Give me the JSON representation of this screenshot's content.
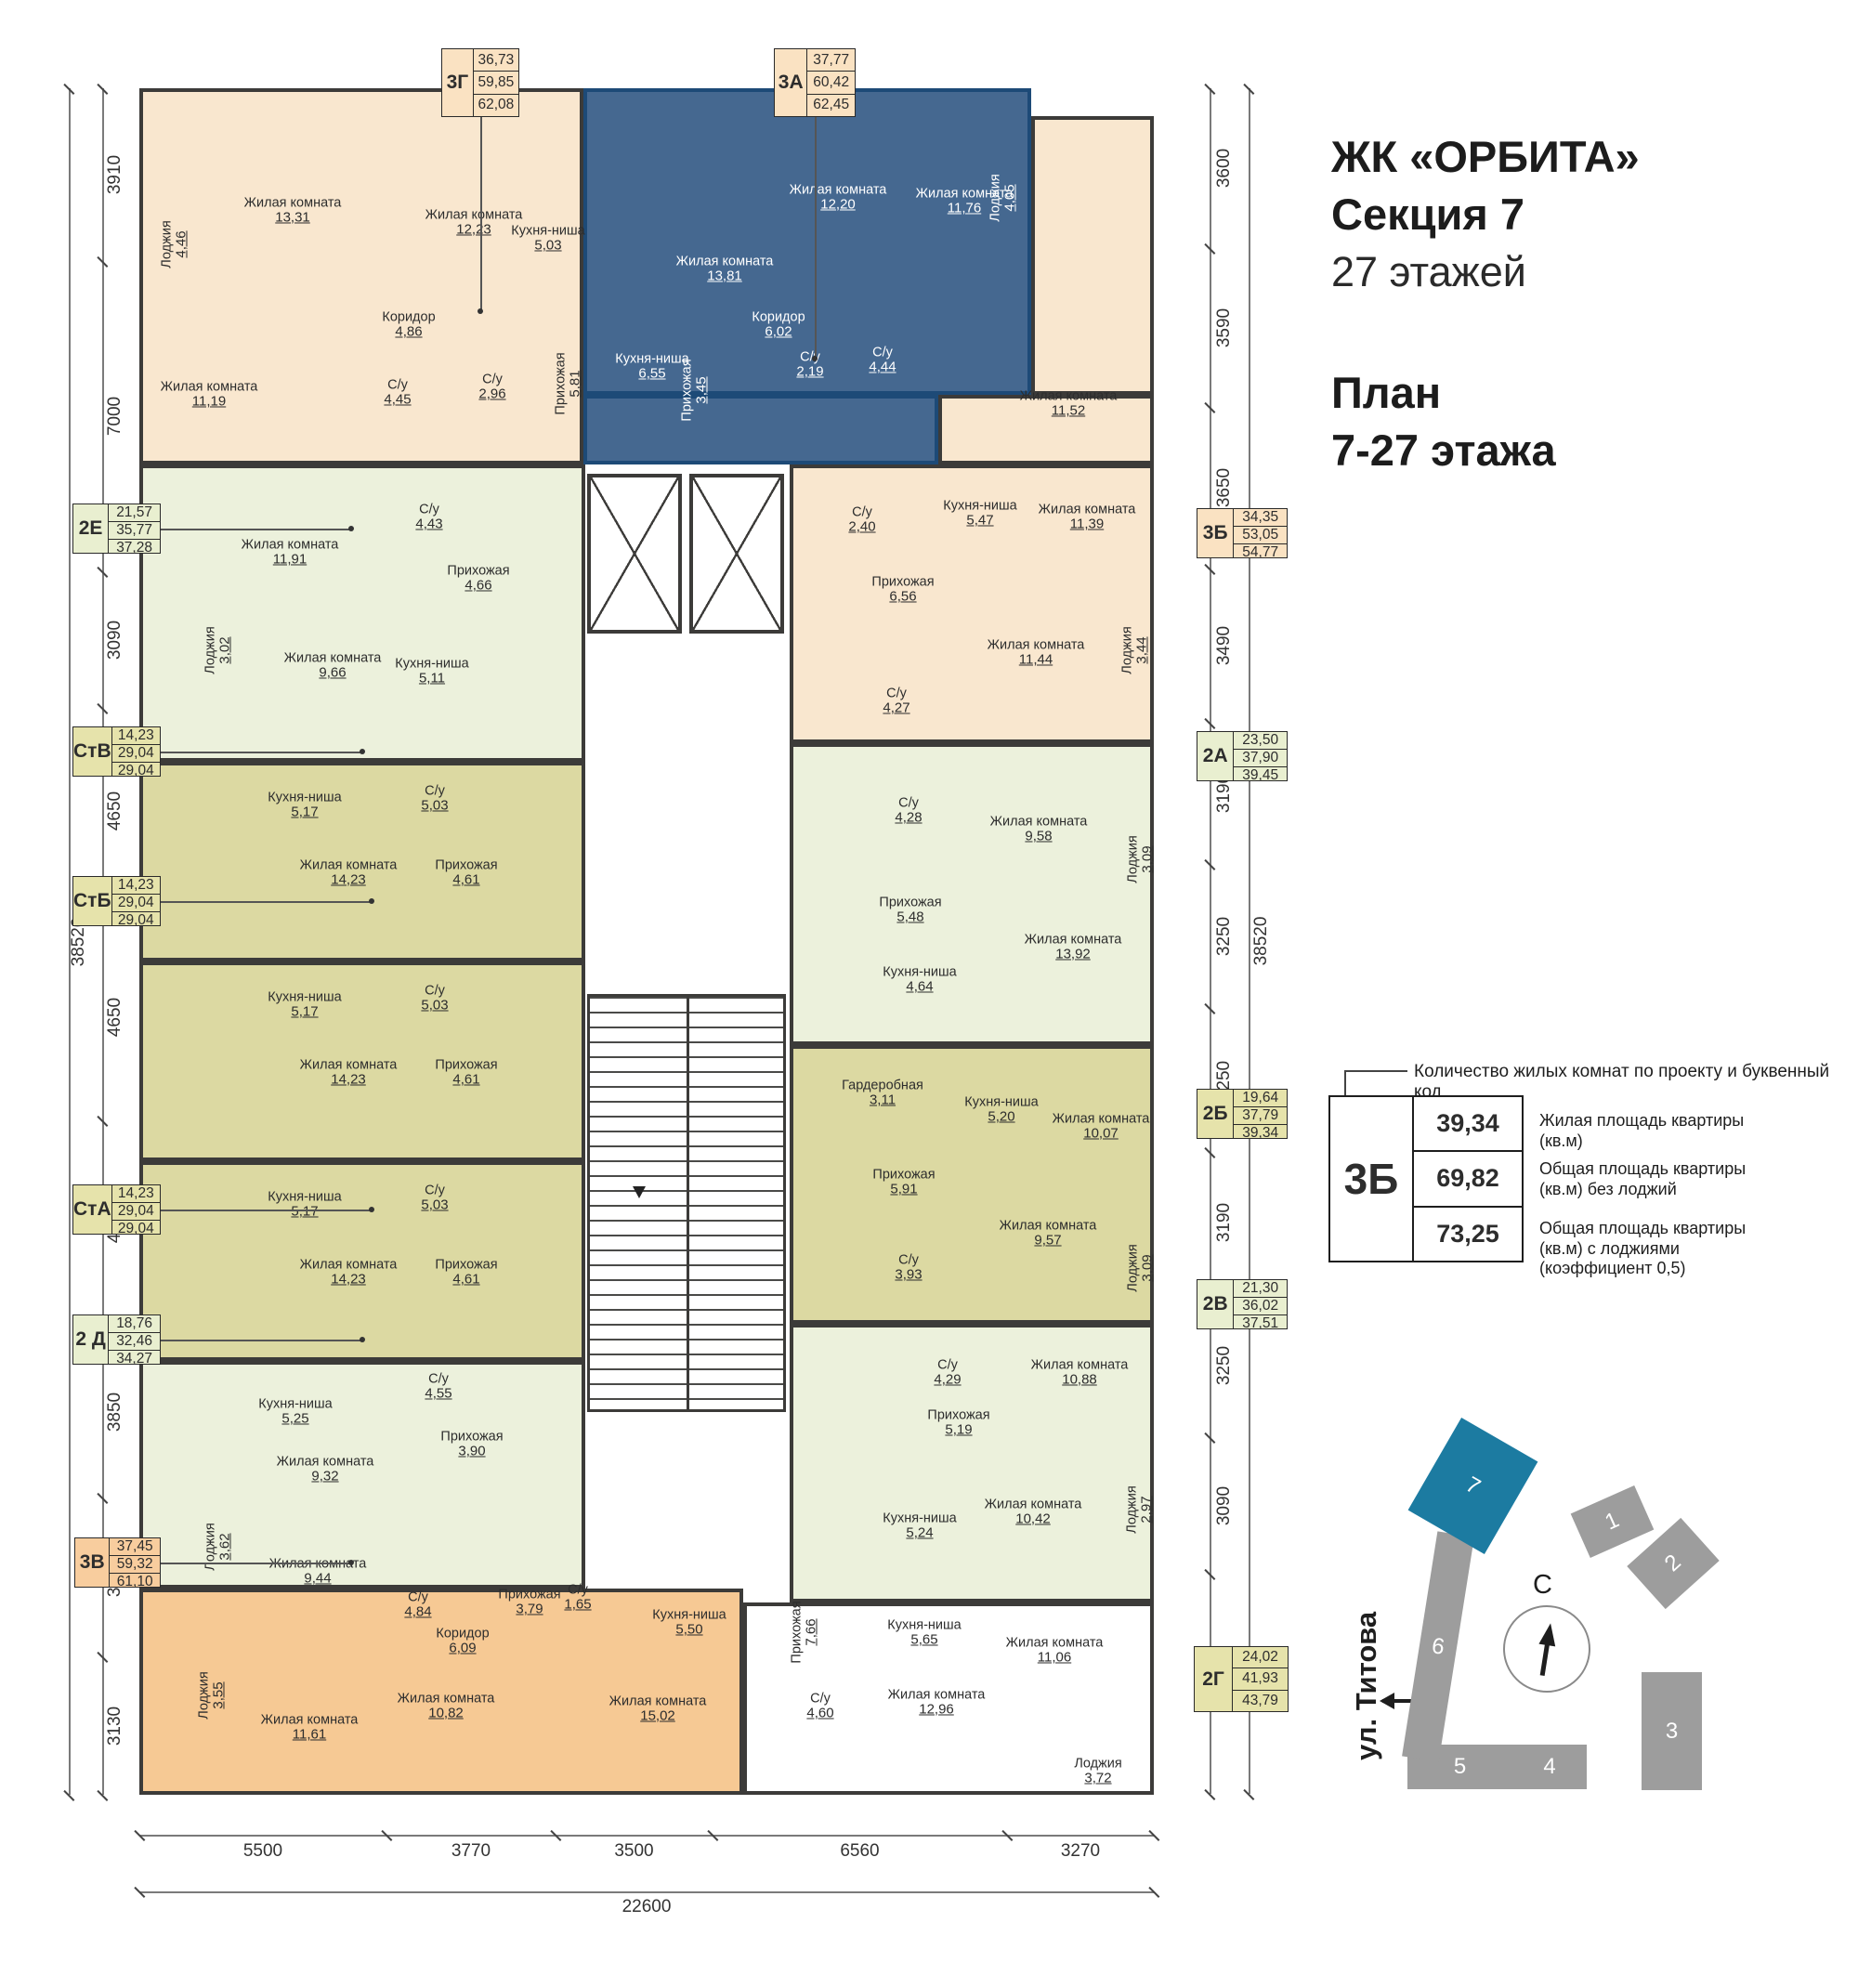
{
  "header": {
    "title": "ЖК «ОРБИТА»",
    "subtitle": "Секция 7",
    "floors": "27 этажей",
    "plan_label": "План",
    "plan_range": "7-27 этажа"
  },
  "legend": {
    "note": "Количество жилых комнат по проекту и буквенный код",
    "example_code": "3Б",
    "rows": [
      {
        "value": "39,34",
        "desc": "Жилая площадь квартиры (кв.м)"
      },
      {
        "value": "69,82",
        "desc": "Общая площадь квартиры (кв.м) без лоджий"
      },
      {
        "value": "73,25",
        "desc": "Общая площадь квартиры (кв.м) с лоджиями (коэффициент 0,5)"
      }
    ]
  },
  "site_plan": {
    "street": "ул. Титова",
    "north_label": "С",
    "buildings": [
      "1",
      "2",
      "3",
      "4",
      "5",
      "6",
      "7"
    ],
    "highlighted_building": "7"
  },
  "dimensions": {
    "left": [
      "3910",
      "7000",
      "3090",
      "4650",
      "4650",
      "4650",
      "3850",
      "3590",
      "3130"
    ],
    "left_total": "38520",
    "right": [
      "3600",
      "3590",
      "3650",
      "3490",
      "3190",
      "3250",
      "3250",
      "3190",
      "3250",
      "3090",
      "4970"
    ],
    "right_total": "38520",
    "bottom": [
      "5500",
      "3770",
      "3500",
      "6560",
      "3270"
    ],
    "bottom_total": "22600"
  },
  "colors": {
    "wall": "#3c3b39",
    "blue_wall": "#1d4a77",
    "site_gray": "#9d9d9d",
    "site_teal": "#1c7ba1"
  },
  "apartments": [
    {
      "id": "3g",
      "code": "3Г",
      "areas": [
        "36,73",
        "59,85",
        "62,08"
      ],
      "fill": "#f9e7cf",
      "label_fill": "#fae2c2",
      "text": "#2d2d2d",
      "rooms": [
        {
          "name": "Лоджия",
          "area": "4,46"
        },
        {
          "name": "Жилая комната",
          "area": "13,31"
        },
        {
          "name": "Жилая комната",
          "area": "12,23"
        },
        {
          "name": "Кухня-ниша",
          "area": "5,03"
        },
        {
          "name": "Коридор",
          "area": "4,86"
        },
        {
          "name": "Жилая комната",
          "area": "11,19"
        },
        {
          "name": "С/у",
          "area": "4,45"
        },
        {
          "name": "С/у",
          "area": "2,96"
        },
        {
          "name": "Прихожая",
          "area": "5,81"
        }
      ]
    },
    {
      "id": "3a",
      "code": "3А",
      "areas": [
        "37,77",
        "60,42",
        "62,45"
      ],
      "fill": "#456890",
      "label_fill": "#fae2c2",
      "text": "#ffffff",
      "rooms": [
        {
          "name": "Жилая комната",
          "area": "13,81"
        },
        {
          "name": "Жилая комната",
          "area": "12,20"
        },
        {
          "name": "Жилая комната",
          "area": "11,76"
        },
        {
          "name": "Лоджия",
          "area": "4,05"
        },
        {
          "name": "Кухня-ниша",
          "area": "6,55"
        },
        {
          "name": "Прихожая",
          "area": "3,45"
        },
        {
          "name": "Коридор",
          "area": "6,02"
        },
        {
          "name": "С/у",
          "area": "2,19"
        },
        {
          "name": "С/у",
          "area": "4,44"
        }
      ]
    },
    {
      "id": "3b",
      "code": "3Б",
      "areas": [
        "34,35",
        "53,05",
        "54,77"
      ],
      "fill": "#f9e7cf",
      "label_fill": "#fae2c2",
      "text": "#2d2d2d",
      "rooms": [
        {
          "name": "Жилая комната",
          "area": "11,52"
        },
        {
          "name": "Жилая комната",
          "area": "11,39"
        },
        {
          "name": "Кухня-ниша",
          "area": "5,47"
        },
        {
          "name": "С/у",
          "area": "2,40"
        },
        {
          "name": "Прихожая",
          "area": "6,56"
        },
        {
          "name": "С/у",
          "area": "4,27"
        },
        {
          "name": "Жилая комната",
          "area": "11,44"
        },
        {
          "name": "Лоджия",
          "area": "3,44"
        }
      ]
    },
    {
      "id": "2e",
      "code": "2Е",
      "areas": [
        "21,57",
        "35,77",
        "37,28"
      ],
      "fill": "#ecf1dc",
      "label_fill": "#e9efd0",
      "text": "#2d2d2d",
      "rooms": [
        {
          "name": "Жилая комната",
          "area": "11,91"
        },
        {
          "name": "С/у",
          "area": "4,43"
        },
        {
          "name": "Прихожая",
          "area": "4,66"
        },
        {
          "name": "Лоджия",
          "area": "3,02"
        },
        {
          "name": "Жилая комната",
          "area": "9,66"
        },
        {
          "name": "Кухня-ниша",
          "area": "5,11"
        }
      ]
    },
    {
      "id": "stv",
      "code": "СтВ",
      "areas": [
        "14,23",
        "29,04",
        "29,04"
      ],
      "fill": "#dcd9a2",
      "label_fill": "#e6e3ab",
      "text": "#2d2d2d",
      "rooms": [
        {
          "name": "Кухня-ниша",
          "area": "5,17"
        },
        {
          "name": "С/у",
          "area": "5,03"
        },
        {
          "name": "Жилая комната",
          "area": "14,23"
        },
        {
          "name": "Прихожая",
          "area": "4,61"
        }
      ]
    },
    {
      "id": "stb",
      "code": "СтБ",
      "areas": [
        "14,23",
        "29,04",
        "29,04"
      ],
      "fill": "#dcd9a2",
      "label_fill": "#e6e3ab",
      "text": "#2d2d2d",
      "rooms": [
        {
          "name": "Кухня-ниша",
          "area": "5,17"
        },
        {
          "name": "С/у",
          "area": "5,03"
        },
        {
          "name": "Жилая комната",
          "area": "14,23"
        },
        {
          "name": "Прихожая",
          "area": "4,61"
        }
      ]
    },
    {
      "id": "sta",
      "code": "СтА",
      "areas": [
        "14,23",
        "29,04",
        "29,04"
      ],
      "fill": "#dcd9a2",
      "label_fill": "#e6e3ab",
      "text": "#2d2d2d",
      "rooms": [
        {
          "name": "Кухня-ниша",
          "area": "5,17"
        },
        {
          "name": "С/у",
          "area": "5,03"
        },
        {
          "name": "Жилая комната",
          "area": "14,23"
        },
        {
          "name": "Прихожая",
          "area": "4,61"
        }
      ]
    },
    {
      "id": "2d",
      "code": "2 Д",
      "areas": [
        "18,76",
        "32,46",
        "34,27"
      ],
      "fill": "#ecf1dc",
      "label_fill": "#e9efd0",
      "text": "#2d2d2d",
      "rooms": [
        {
          "name": "Кухня-ниша",
          "area": "5,25"
        },
        {
          "name": "С/у",
          "area": "4,55"
        },
        {
          "name": "Жилая комната",
          "area": "9,32"
        },
        {
          "name": "Прихожая",
          "area": "3,90"
        },
        {
          "name": "Лоджия",
          "area": "3,62"
        },
        {
          "name": "Жилая комната",
          "area": "9,44"
        }
      ]
    },
    {
      "id": "3v",
      "code": "3В",
      "areas": [
        "37,45",
        "59,32",
        "61,10"
      ],
      "fill": "#f6c994",
      "label_fill": "#f8cd9e",
      "text": "#2d2d2d",
      "rooms": [
        {
          "name": "Лоджия",
          "area": "3,55"
        },
        {
          "name": "Жилая комната",
          "area": "11,61"
        },
        {
          "name": "С/у",
          "area": "4,84"
        },
        {
          "name": "Коридор",
          "area": "6,09"
        },
        {
          "name": "Прихожая",
          "area": "3,79"
        },
        {
          "name": "С/у",
          "area": "1,65"
        },
        {
          "name": "Кухня-ниша",
          "area": "5,50"
        },
        {
          "name": "Жилая комната",
          "area": "15,02"
        },
        {
          "name": "Жилая комната",
          "area": "10,82"
        }
      ]
    },
    {
      "id": "2a",
      "code": "2А",
      "areas": [
        "23,50",
        "37,90",
        "39,45"
      ],
      "fill": "#ecf1dc",
      "label_fill": "#e9efd0",
      "text": "#2d2d2d",
      "rooms": [
        {
          "name": "С/у",
          "area": "4,28"
        },
        {
          "name": "Жилая комната",
          "area": "9,58"
        },
        {
          "name": "Лоджия",
          "area": "3,09"
        },
        {
          "name": "Прихожая",
          "area": "5,48"
        },
        {
          "name": "Кухня-ниша",
          "area": "4,64"
        },
        {
          "name": "Жилая комната",
          "area": "13,92"
        }
      ]
    },
    {
      "id": "2b",
      "code": "2Б",
      "areas": [
        "19,64",
        "37,79",
        "39,34"
      ],
      "fill": "#dcd9a2",
      "label_fill": "#e6e3ab",
      "text": "#2d2d2d",
      "rooms": [
        {
          "name": "Гардеробная",
          "area": "3,11"
        },
        {
          "name": "Кухня-ниша",
          "area": "5,20"
        },
        {
          "name": "Жилая комната",
          "area": "10,07"
        },
        {
          "name": "Прихожая",
          "area": "5,91"
        },
        {
          "name": "С/у",
          "area": "3,93"
        },
        {
          "name": "Жилая комната",
          "area": "9,57"
        },
        {
          "name": "Лоджия",
          "area": "3,09"
        }
      ]
    },
    {
      "id": "2v",
      "code": "2В",
      "areas": [
        "21,30",
        "36,02",
        "37,51"
      ],
      "fill": "#ecf1dc",
      "label_fill": "#e9efd0",
      "text": "#2d2d2d",
      "rooms": [
        {
          "name": "С/у",
          "area": "4,29"
        },
        {
          "name": "Жилая комната",
          "area": "10,88"
        },
        {
          "name": "Прихожая",
          "area": "5,19"
        },
        {
          "name": "Кухня-ниша",
          "area": "5,24"
        },
        {
          "name": "Жилая комната",
          "area": "10,42"
        },
        {
          "name": "Лоджия",
          "area": "2,97"
        }
      ]
    },
    {
      "id": "2g",
      "code": "2Г",
      "areas": [
        "24,02",
        "41,93",
        "43,79"
      ],
      "fill": "#ffffff",
      "label_fill": "#e6e3ab",
      "text": "#2d2d2d",
      "rooms": [
        {
          "name": "Прихожая",
          "area": "7,66"
        },
        {
          "name": "Кухня-ниша",
          "area": "5,65"
        },
        {
          "name": "Жилая комната",
          "area": "12,96"
        },
        {
          "name": "С/у",
          "area": "4,60"
        },
        {
          "name": "Жилая комната",
          "area": "11,06"
        },
        {
          "name": "Лоджия",
          "area": "3,72"
        }
      ]
    }
  ]
}
